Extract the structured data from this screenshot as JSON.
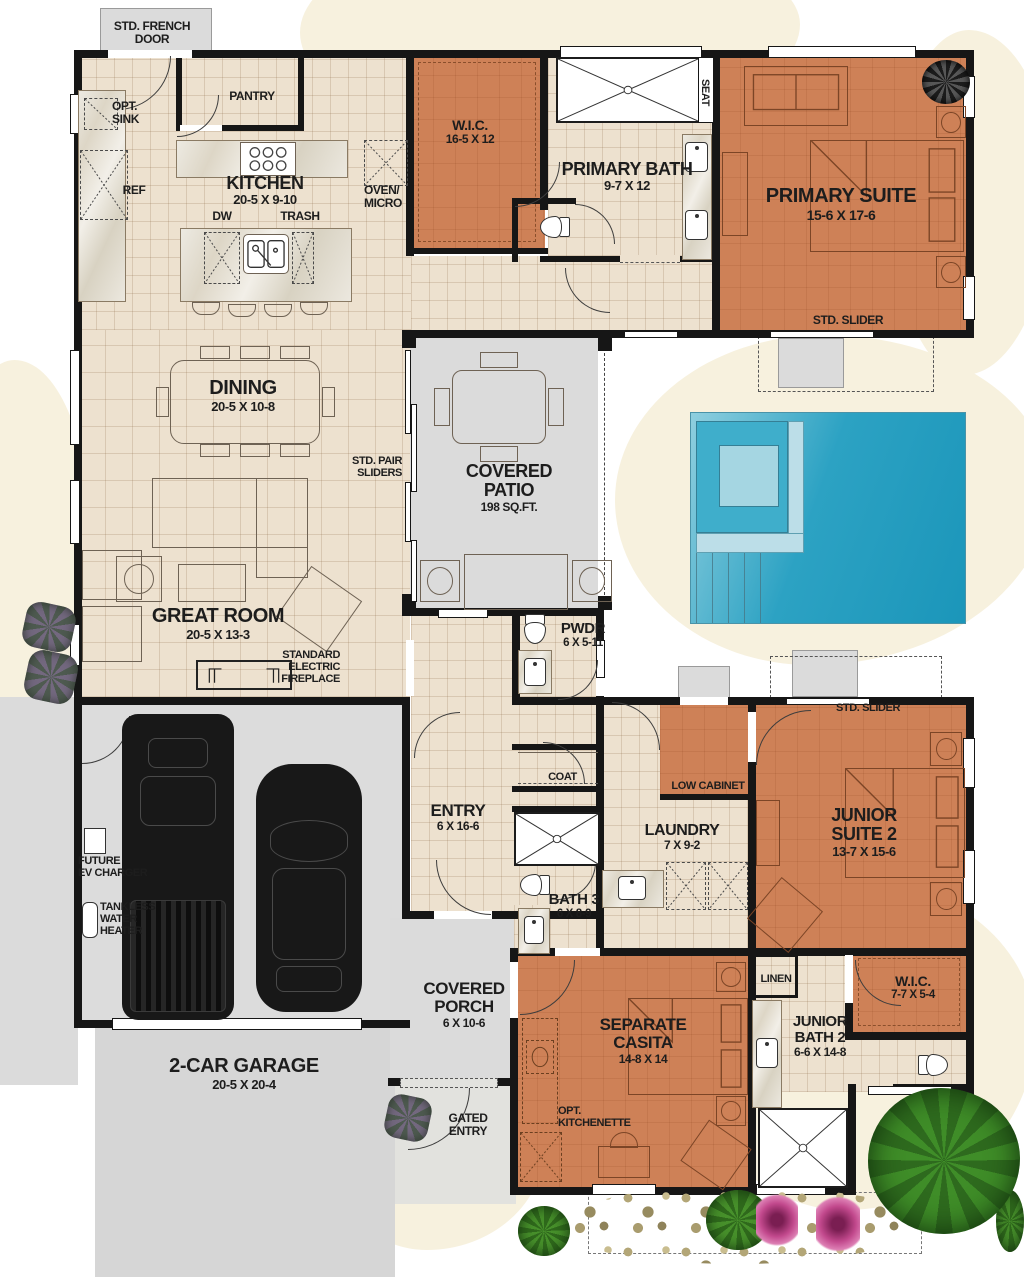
{
  "labels": {
    "std_french_door": "STD. FRENCH\nDOOR",
    "opt_sink": "OPT.\nSINK",
    "pantry": "PANTRY",
    "kitchen_name": "KITCHEN",
    "kitchen_dims": "20-5 X 9-10",
    "ref": "REF",
    "dw": "DW",
    "trash": "TRASH",
    "oven_micro": "OVEN/\nMICRO",
    "wic1_name": "W.I.C.",
    "wic1_dims": "16-5 X 12",
    "primary_bath_name": "PRIMARY BATH",
    "primary_bath_dims": "9-7 X 12",
    "seat": "SEAT",
    "primary_suite_name": "PRIMARY SUITE",
    "primary_suite_dims": "15-6 X 17-6",
    "std_slider_primary": "STD. SLIDER",
    "dining_name": "DINING",
    "dining_dims": "20-5 X 10-8",
    "std_pair_sliders": "STD. PAIR\nSLIDERS",
    "covered_patio_name": "COVERED\nPATIO",
    "covered_patio_area": "198 SQ.FT.",
    "great_room_name": "GREAT ROOM",
    "great_room_dims": "20-5 X 13-3",
    "fireplace": "STANDARD\nELECTRIC\nFIREPLACE",
    "pwdr_name": "PWDR",
    "pwdr_dims": "6 X 5-11",
    "coat": "COAT",
    "low_cabinet": "LOW CABINET",
    "junior_suite2_name": "JUNIOR\nSUITE 2",
    "junior_suite2_dims": "13-7 X 15-6",
    "std_slider_junior": "STD. SLIDER",
    "entry_name": "ENTRY",
    "entry_dims": "6 X 16-6",
    "laundry_name": "LAUNDRY",
    "laundry_dims": "7 X 9-2",
    "future_ev_charger": "FUTURE\nEV CHARGER",
    "tankless_water_heater": "TANKLESS\nWATER\nHEATER",
    "bath3_name": "BATH 3",
    "bath3_dims": "6 X 8-9",
    "garage_name": "2-CAR GARAGE",
    "garage_dims": "20-5 X 20-4",
    "covered_porch_name": "COVERED\nPORCH",
    "covered_porch_dims": "6 X 10-6",
    "gated_entry": "GATED\nENTRY",
    "casita_name": "SEPARATE\nCASITA",
    "casita_dims": "14-8 X 14",
    "opt_kitchenette": "OPT.\nKITCHENETTE",
    "linen": "LINEN",
    "wic2_name": "W.I.C.",
    "wic2_dims": "7-7 X 5-4",
    "junior_bath2_name": "JUNIOR\nBATH 2",
    "junior_bath2_dims": "6-6 X 14-8"
  },
  "colors": {
    "floor_tile": "#EDE1CF",
    "suite_accent": "#CE8157",
    "hardscape_gray": "#DBDBDB",
    "pool_blue": "#1E9CBF",
    "spa_light_blue": "#A5D6E2",
    "wall_black": "#161616",
    "lawn_cream": "#F7F1DE",
    "plant_green": "#3A7A24"
  }
}
